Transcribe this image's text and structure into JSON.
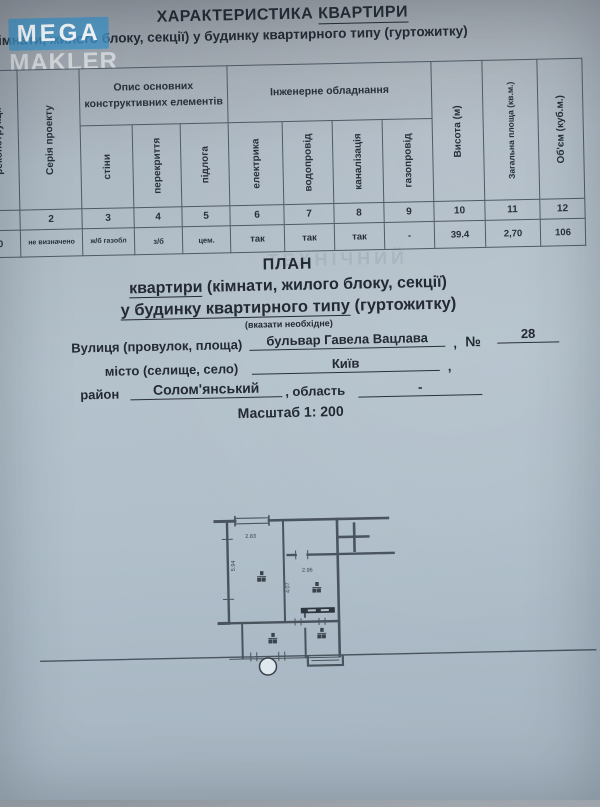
{
  "watermark": {
    "top": "MEGA",
    "bottom": "MAKLER",
    "box_color": "#3e94c8"
  },
  "header": {
    "title_main": "ХАРАКТЕРИСТИКА",
    "title_underlined": "КВАРТИРИ",
    "subtitle": "(кімнати, жилого блоку, секції) у будинку квартирного типу (гуртожитку)"
  },
  "table": {
    "groups": [
      {
        "label": "Опис основних конструктивних елементів"
      },
      {
        "label": "Інженерне обладнання"
      }
    ],
    "columns": [
      {
        "num": "",
        "label": "реконструкції",
        "value": "0"
      },
      {
        "num": "2",
        "label": "Серія проекту",
        "value": "не визначено"
      },
      {
        "num": "3",
        "label": "стіни",
        "value": "ж/б газобл"
      },
      {
        "num": "4",
        "label": "перекриття",
        "value": "з/б"
      },
      {
        "num": "5",
        "label": "підлога",
        "value": "цем."
      },
      {
        "num": "6",
        "label": "електрика",
        "value": "так"
      },
      {
        "num": "7",
        "label": "водопровід",
        "value": "так"
      },
      {
        "num": "8",
        "label": "каналізація",
        "value": "так"
      },
      {
        "num": "9",
        "label": "газопровід",
        "value": "-"
      },
      {
        "num": "10",
        "label": "Висота (м)",
        "value": "39.4"
      },
      {
        "num": "11",
        "label": "Загальна площа (кв.м.)",
        "value": "2,70"
      },
      {
        "num": "12",
        "label": "Об'єм (куб.м.)",
        "value": "106"
      }
    ]
  },
  "plan": {
    "heading": "ПЛАН",
    "line2_underlined": "квартири",
    "line2_rest": " (кімнати, жилого блоку, секції)",
    "line3_underlined": "у будинку квартирного типу",
    "line3_rest": " (гуртожитку)",
    "note": "(вказати необхідне)",
    "ghost_text": "ТЕХНІЧНИЙ"
  },
  "address": {
    "street_label": "Вулиця (провулок, площа)",
    "street_value": "бульвар Гавела Вацлава",
    "comma1": ",",
    "number_sign": "№",
    "number_value": "28",
    "city_label": "місто (селище, село)",
    "city_value": "Київ",
    "comma2": ",",
    "district_label": "район",
    "district_value": "Солом'янський",
    "oblast_label": ", область",
    "oblast_value": "-",
    "scale": "Масштаб 1: 200"
  },
  "floor_plan": {
    "dim_top": "2.83",
    "dim_left": "5.94",
    "dim_mid": "4.07",
    "dim_right": "2.96"
  }
}
